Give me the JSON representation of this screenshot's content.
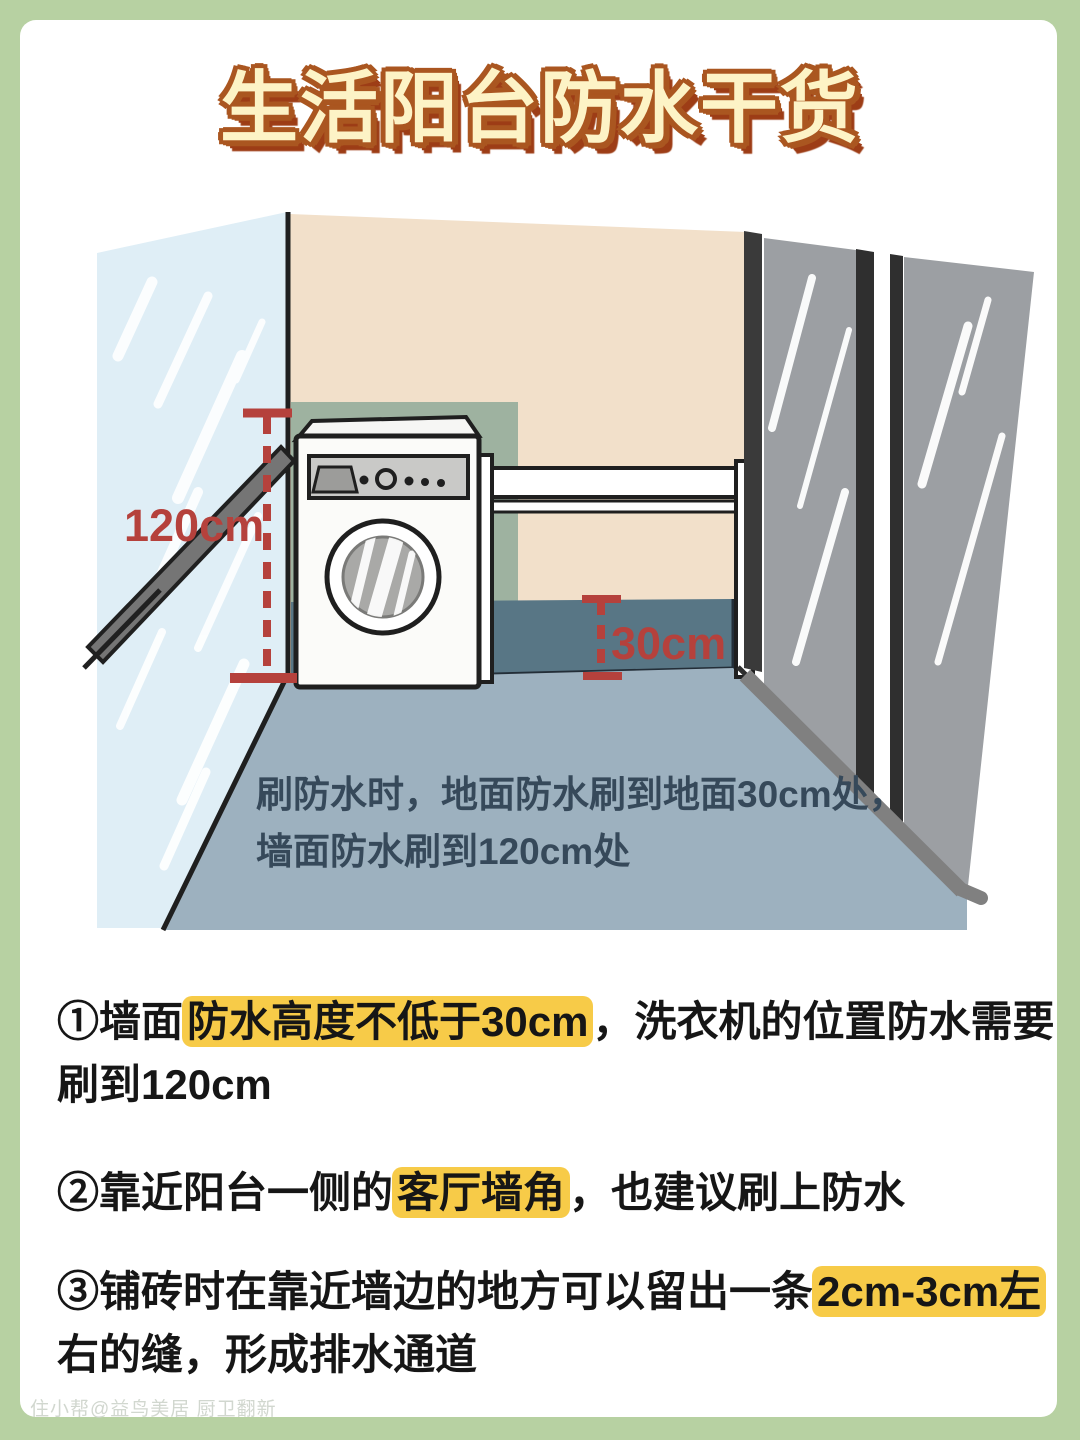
{
  "page": {
    "background_color": "#b7d1a2",
    "card_color": "#ffffff"
  },
  "title": {
    "text": "生活阳台防水干货",
    "fill_color": "#fdf3c6",
    "outline_color": "#aa5620",
    "shadow_color": "#9d3d16"
  },
  "illustration": {
    "labels": {
      "wall_height": "120cm",
      "floor_height": "30cm"
    },
    "caption": {
      "line1": "刷防水时，地面防水刷到地面30cm处，",
      "line2": "墙面防水刷到120cm处"
    },
    "colors": {
      "window_glass": "#dfeef6",
      "wall": "#f2e0ca",
      "waterproof_wall_zone": "#9eb2a0",
      "waterproof_floor_band": "#587685",
      "floor": "#9db1bf",
      "door_glass": "#9c9fa3",
      "measure_red": "#b5413c"
    }
  },
  "points": [
    {
      "lines": [
        {
          "pre": "①墙面",
          "hl": "防水高度不低于30cm",
          "post": "，洗衣机的位置防水需要"
        },
        {
          "pre": "刷到120cm",
          "hl": "",
          "post": ""
        }
      ]
    },
    {
      "lines": [
        {
          "pre": "②靠近阳台一侧的",
          "hl": "客厅墙角",
          "post": "，也建议刷上防水"
        }
      ]
    },
    {
      "lines": [
        {
          "pre": "③铺砖时在靠近墙边的地方可以留出一条",
          "hl": "2cm-3cm左",
          "post": ""
        },
        {
          "pre": "右的缝，形成排水通道",
          "hl": "",
          "post": ""
        }
      ]
    }
  ],
  "highlight_color": "#f7c83e",
  "watermark": "住小帮@益鸟美居 厨卫翻新"
}
